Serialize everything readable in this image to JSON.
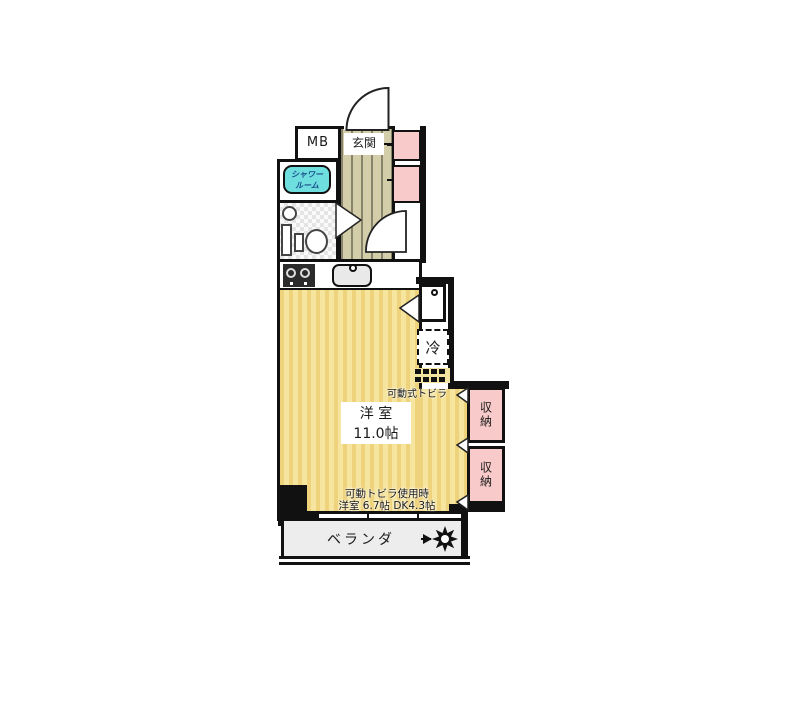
{
  "floorplan": {
    "rooms": {
      "mb": "MB",
      "entrance": "玄関",
      "shower_line1": "シャワー",
      "shower_line2": "ルーム",
      "fridge": "冷",
      "movable_door": "可動式トビラ",
      "main_room_name": "洋 室",
      "main_room_size": "11.0帖",
      "storage_a": "収納",
      "storage_b": "収納",
      "balcony": "ベランダ",
      "note_line1": "可動トビラ使用時",
      "note_line2": "洋室 6.7帖 DK4.3帖"
    },
    "colors": {
      "wall": "#111111",
      "wood_floor": "#f2dd8c",
      "hall_floor": "#d3cda9",
      "closet_pink": "#f8caca",
      "tub_teal": "#6edede",
      "balcony_gray": "#ededed",
      "tub_text": "#1b4f8a"
    }
  }
}
